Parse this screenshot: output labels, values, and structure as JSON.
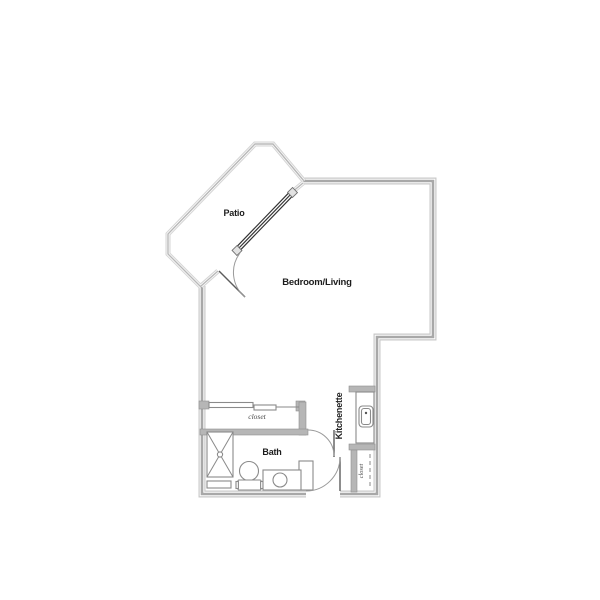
{
  "floorplan": {
    "labels": {
      "patio": "Patio",
      "bedroom_living": "Bedroom/Living",
      "closet": "closet",
      "bath": "Bath",
      "kitchenette": "Kitchenette",
      "entry_closet": "closet"
    },
    "fixtures": {
      "patio_door": "sliding-glass-door",
      "closet_doors": "bypass-sliding-doors",
      "shower": "shower-stall-x",
      "toilet": "toilet",
      "bathroom_sink": "vanity-sink",
      "kitchen_sink": "kitchen-sink",
      "entry_shelf": "dashed-shelf-line"
    },
    "colors": {
      "background": "#ffffff",
      "wall_core": "#a8a8a8",
      "wall_edge": "#c9c9c9",
      "patio_wall": "#b8b8b8",
      "partition_fill": "#b6b6b6",
      "fixture_outline": "#8a8a8a",
      "door_swing": "#9a9a9a",
      "slider_line": "#333333",
      "text": "#1c1c1c"
    }
  }
}
